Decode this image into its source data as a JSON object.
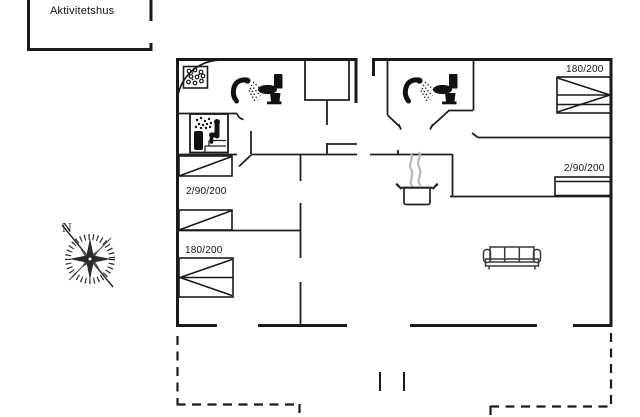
{
  "annex": {
    "label": "Aktivitetshus"
  },
  "compass": {
    "north_label": "N"
  },
  "plan": {
    "left_wing": {
      "bedroom_twin_label": "2/90/200",
      "bedroom_double_label": "180/200"
    },
    "right_wing": {
      "bedroom_double_label": "180/200",
      "bedroom_bunk_label": "2/90/200"
    }
  },
  "icons": {
    "shower": "shower-icon",
    "toilet": "toilet-icon",
    "sauna": "sauna-icon",
    "shower_tray": "shower-tray-icon",
    "stove": "cooking-pot-icon",
    "sofa": "sofa-icon",
    "compass_rose": "compass-rose-icon"
  },
  "colors": {
    "wall": "#1a1a1a",
    "fixture": "#111111",
    "steam": "#b9b9b9",
    "furniture_outline": "#3a3a3a",
    "background": "#ffffff"
  }
}
